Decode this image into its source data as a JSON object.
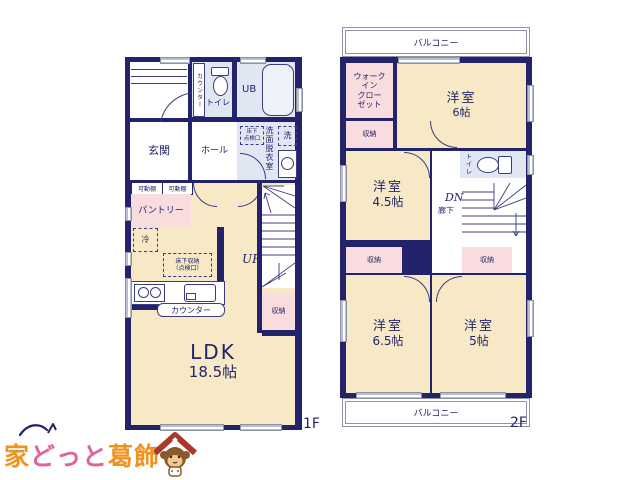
{
  "colors": {
    "wall": "#23236b",
    "cream": "#f7e9c6",
    "pink": "#f9dcdd",
    "blue": "#dfe7f3",
    "line": "#3c3c80",
    "logo_orange": "#ef9220",
    "logo_pink": "#e0639c",
    "roof_red": "#a8392c"
  },
  "floor1": {
    "label": "1F",
    "counter_side": "カウンター",
    "toilet": "トイレ",
    "ub": "UB",
    "genkan": "玄関",
    "hall": "ホール",
    "washroom": "洗面脱衣室",
    "laundry": "洗",
    "hatch": "床下\n点検口",
    "shelf1": "可動棚",
    "shelf2": "可動棚",
    "pantry": "パントリー",
    "fridge": "冷",
    "underfloor": "床下収納\n（点検口）",
    "counter": "カウンター",
    "up": "UP",
    "storage": "収納",
    "ldk": "LDK",
    "ldk_size": "18.5帖"
  },
  "floor2": {
    "label": "2F",
    "balcony_top": "バルコニー",
    "balcony_bottom": "バルコニー",
    "wic": "ウォーク\nイン\nクロー\nゼット",
    "room6": "洋室",
    "room6_size": "6帖",
    "wic_storage": "収納",
    "room45": "洋室",
    "room45_size": "4.5帖",
    "toilet": "トイレ",
    "dn": "DN",
    "corridor": "廊下",
    "storage_left": "収納",
    "storage_right": "収納",
    "room65": "洋室",
    "room65_size": "6.5帖",
    "room5": "洋室",
    "room5_size": "5帖"
  },
  "logo": {
    "ie": "家",
    "dotto": "どっと",
    "katsushika": "葛飾"
  }
}
